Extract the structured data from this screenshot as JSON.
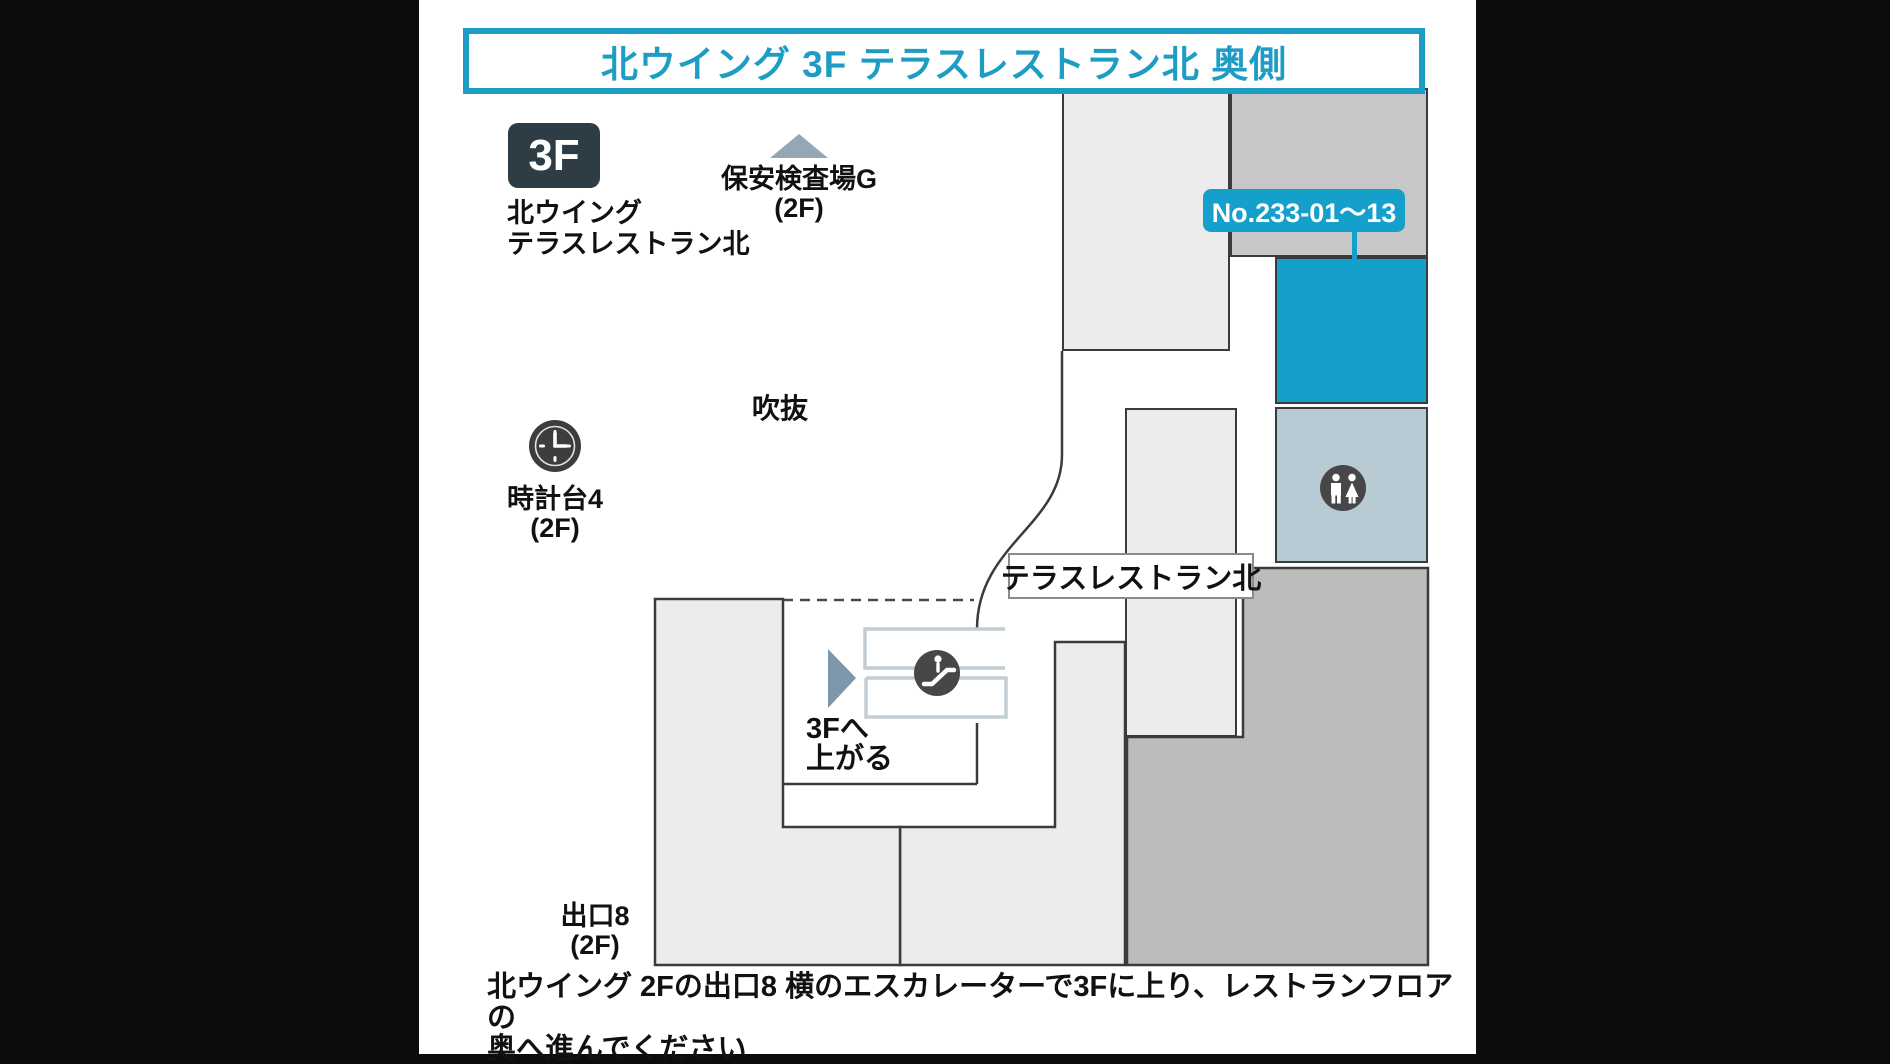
{
  "title": {
    "text": "北ウイング 3F テラスレストラン北 奥側"
  },
  "floor_badge": {
    "label": "3F",
    "caption_line1": "北ウイング",
    "caption_line2": "テラスレストラン北"
  },
  "landmarks": {
    "security_checkpoint": {
      "name": "保安検査場G",
      "floor": "(2F)"
    },
    "atrium": {
      "name": "吹抜"
    },
    "clock_tower": {
      "name": "時計台4",
      "floor": "(2F)"
    },
    "exit8": {
      "name": "出口8",
      "floor": "(2F)"
    }
  },
  "destination": {
    "shop_numbers": "No.233-01〜13",
    "area_label": "テラスレストラン北"
  },
  "escalator": {
    "direction_line1": "3Fへ",
    "direction_line2": "上がる"
  },
  "route_note": {
    "line1": "北ウイング 2Fの出口8 横のエスカレーターで3Fに上り、レストランフロアの",
    "line2": "奥へ進んでください"
  },
  "icons": {
    "security_direction": "up-triangle-icon",
    "clock": "clock-icon",
    "escalator": "escalator-icon",
    "restroom": "restroom-icon",
    "route_direction": "right-triangle-icon"
  },
  "colors": {
    "accent_teal": "#1d9dc4",
    "highlight_room_teal": "#14a0ca",
    "badge_dark": "#2e3d45",
    "restroom_area_bluegray": "#b8cad4",
    "building_light_gray": "#ececec",
    "building_mid_gray": "#c7c7c7",
    "building_dark_gray": "#bcbcbc",
    "icon_dark": "#474747"
  }
}
